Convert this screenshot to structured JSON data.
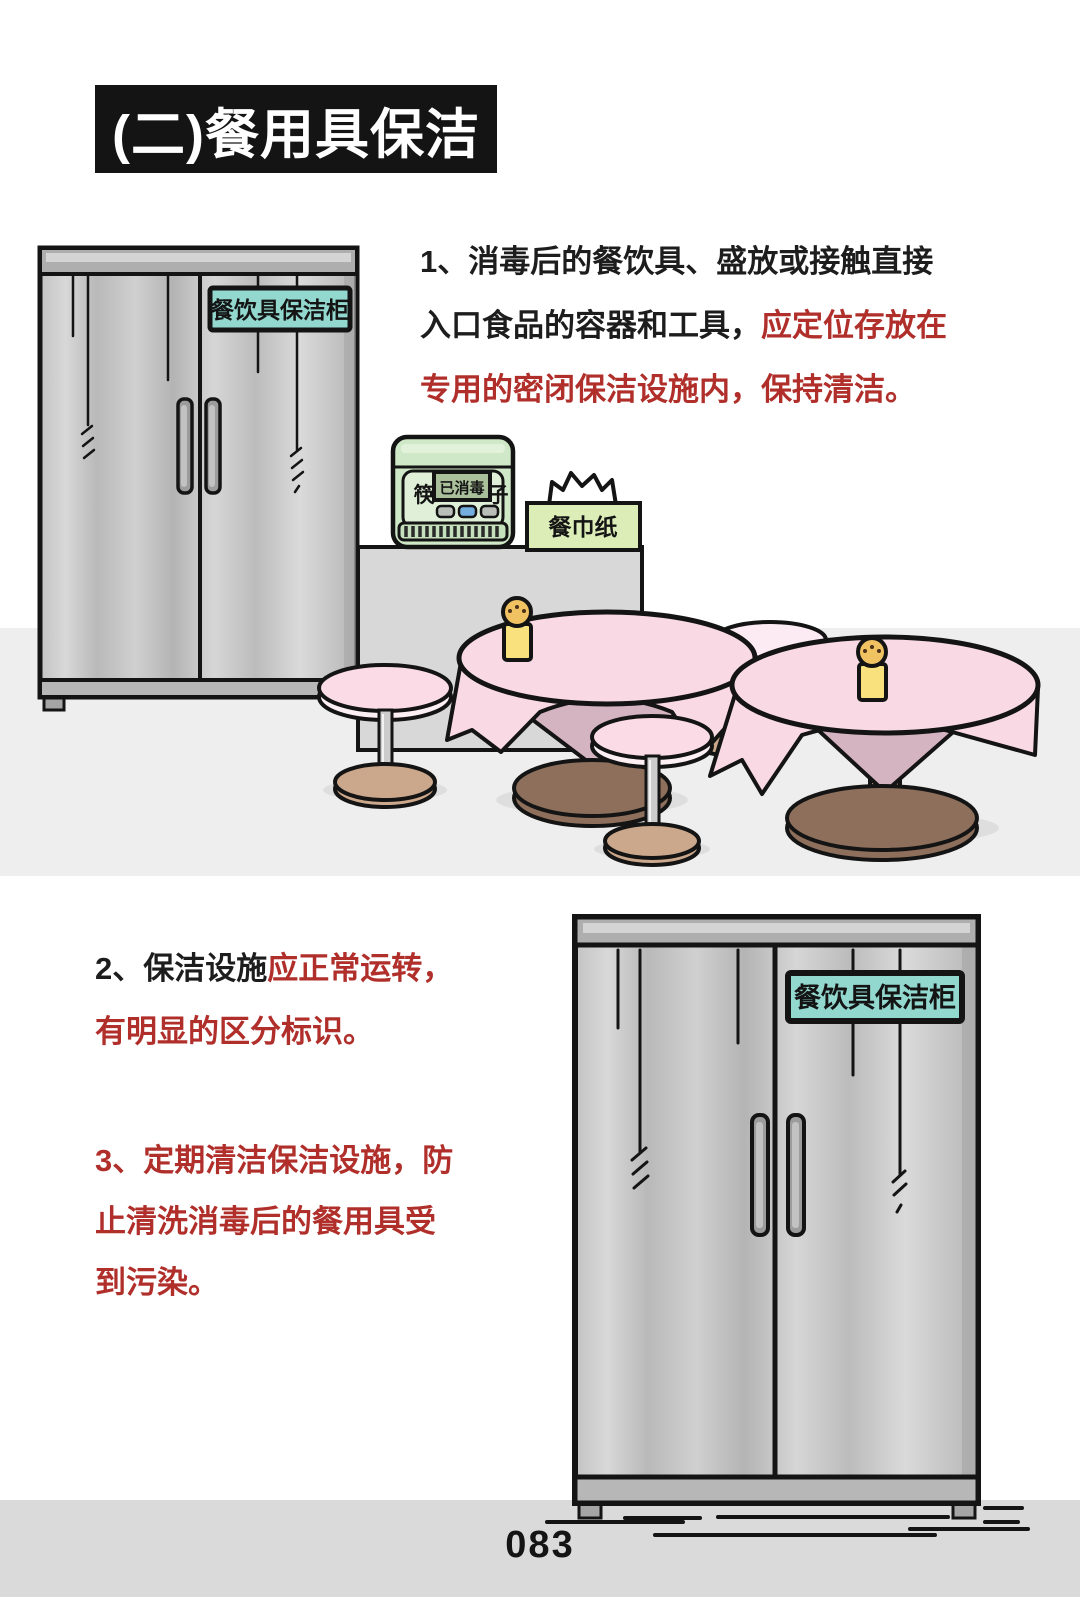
{
  "header": {
    "title": "(二)餐用具保洁"
  },
  "paragraphs": {
    "p1": {
      "lines": [
        {
          "black": "1、消毒后的餐饮具、盛放或接触直接",
          "red": ""
        },
        {
          "black": "入口食品的容器和工具，",
          "red": "应定位存放在"
        },
        {
          "black": "",
          "red": "专用的密闭保洁设施内，保持清洁。"
        }
      ]
    },
    "p2": {
      "lines": [
        {
          "black": "2、保洁设施",
          "red": "应正常运转，"
        },
        {
          "black": "",
          "red": "有明显的区分标识。"
        }
      ]
    },
    "p3": {
      "lines": [
        {
          "black": "",
          "red": "3、定期清洁保洁设施，防"
        },
        {
          "black": "",
          "red": "止清洗消毒后的餐用具受"
        },
        {
          "black": "",
          "red": "到污染。"
        }
      ]
    }
  },
  "scene1": {
    "cabinet_sign": "餐饮具保洁柜",
    "sterilizer": {
      "left_char": "筷",
      "display": "已消毒",
      "right_char": "子"
    },
    "tissue_box_label": "餐巾纸"
  },
  "scene2": {
    "cabinet_sign": "餐饮具保洁柜"
  },
  "footer": {
    "page_number": "083"
  },
  "colors": {
    "red_text": "#b02f2b",
    "black_text": "#1d1d1d",
    "sign_teal": "#92d8cf",
    "machine_green": "#cfe8c7",
    "machine_panel": "#e0f0d8",
    "display_green": "#a9c09b",
    "button_blue": "#74aede",
    "tissue_green": "#dcedb8",
    "cloth_pink": "#f9dae4",
    "cone_pink": "#d5b4c1",
    "big_base_brown": "#8d6f5c",
    "stool_tan": "#cba88c",
    "stand_yellow": "#f9e27d",
    "stand_head": "#f0c261",
    "floor1": "#eeeeee",
    "floor2": "#dadada",
    "cabinet_grey": "#c6c6c6"
  }
}
